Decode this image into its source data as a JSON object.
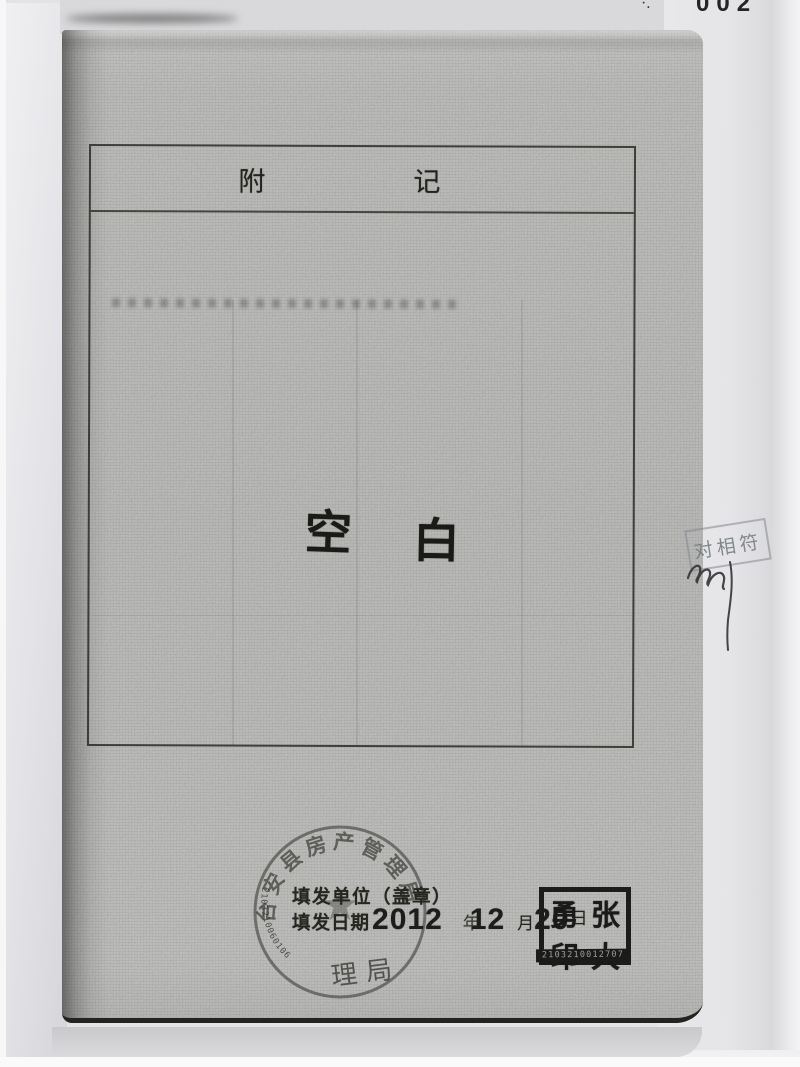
{
  "document": {
    "corner_mark": "·.",
    "corner_number": "002",
    "appendix_box": {
      "title_left": "附",
      "title_right": "记",
      "blank_left": "空",
      "blank_right": "白"
    },
    "issue_section": {
      "unit_label": "填发单位（盖章）",
      "date_label": "填发日期",
      "year_value": "2012",
      "year_unit": "年",
      "month_value": "12",
      "month_unit": "月",
      "day_value": "20",
      "day_unit": "日"
    },
    "official_round_stamp": {
      "arc_text": "台安县房产管理局",
      "rim_serial": "2103210060106",
      "bottom_text": "理局",
      "star_icon": "★"
    },
    "name_seal": {
      "char_top_left": "勇",
      "char_top_right": "张",
      "char_bottom_left": "印",
      "char_bottom_right": "大",
      "serial": "2103210012707"
    },
    "verification_stamp_text": "对相符",
    "colors": {
      "page_gray": "#b7b7b5",
      "ink_black": "#1d1d1b",
      "stamp_gray": "#3c3c39",
      "verification_stamp_gray": "#7a8186"
    }
  }
}
